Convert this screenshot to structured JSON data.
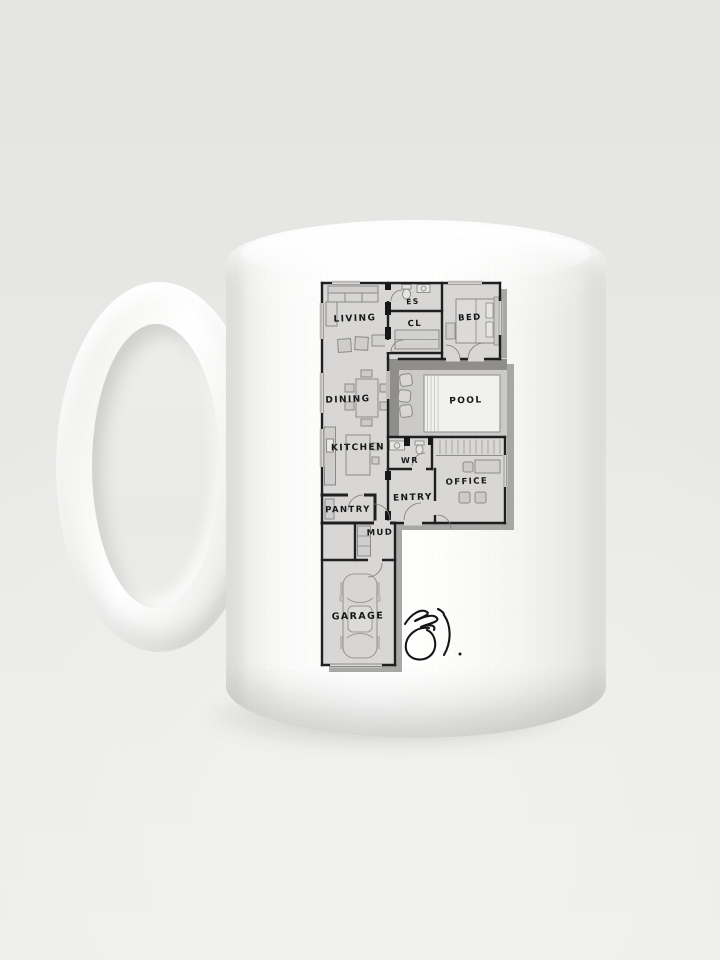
{
  "product": {
    "name": "white ceramic mug with F-shaped floor plan print",
    "background_color": "#e8e8e6",
    "mug_color": "#fbfbfa",
    "shadow_color": "#c9c9c5"
  },
  "plan": {
    "wall_color": "#1f1f1f",
    "room_fill": "#d8d7d5",
    "furniture_line_color": "#8b8b89",
    "drop_shadow_color": "#9f9e9c",
    "rooms": [
      {
        "id": "living",
        "label": "LIVING"
      },
      {
        "id": "es",
        "label": "ES"
      },
      {
        "id": "cl",
        "label": "CL"
      },
      {
        "id": "bed",
        "label": "BED"
      },
      {
        "id": "dining",
        "label": "DINING"
      },
      {
        "id": "pool",
        "label": "POOL"
      },
      {
        "id": "kitchen",
        "label": "KITCHEN"
      },
      {
        "id": "wr",
        "label": "WR"
      },
      {
        "id": "office",
        "label": "OFFICE"
      },
      {
        "id": "entry",
        "label": "ENTRY"
      },
      {
        "id": "pantry",
        "label": "PANTRY"
      },
      {
        "id": "mud",
        "label": "MUD"
      },
      {
        "id": "garage",
        "label": "GARAGE"
      }
    ]
  }
}
